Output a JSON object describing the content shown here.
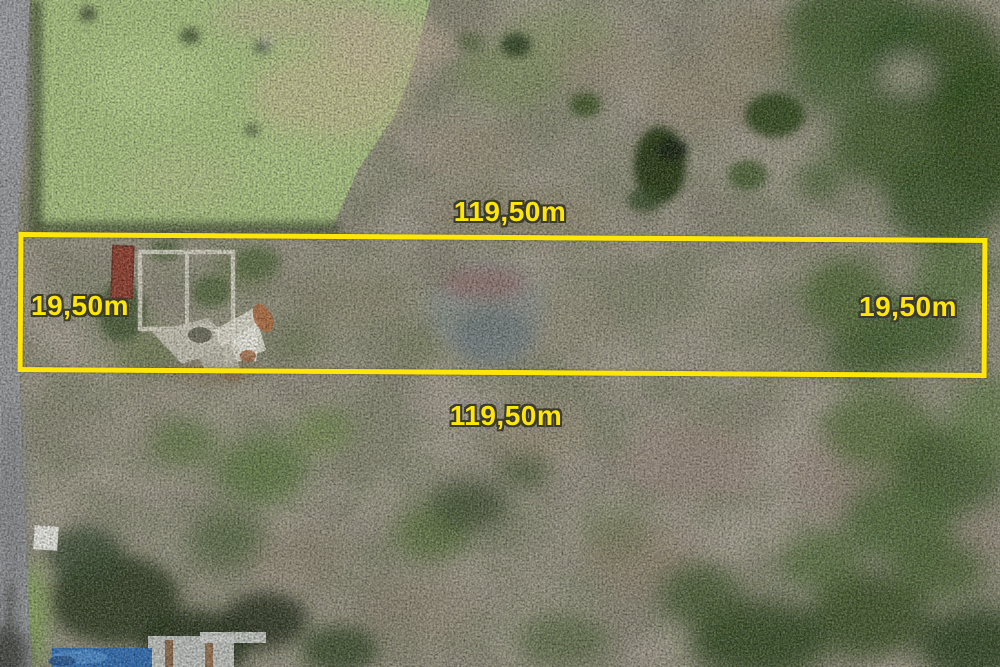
{
  "plot_annotations": {
    "boundary_color": "#ffe60a",
    "label_color": "#ffe60a",
    "labels": {
      "top": "119,50m",
      "bottom": "119,50m",
      "left": "19,50m",
      "right": "19,50m"
    }
  }
}
